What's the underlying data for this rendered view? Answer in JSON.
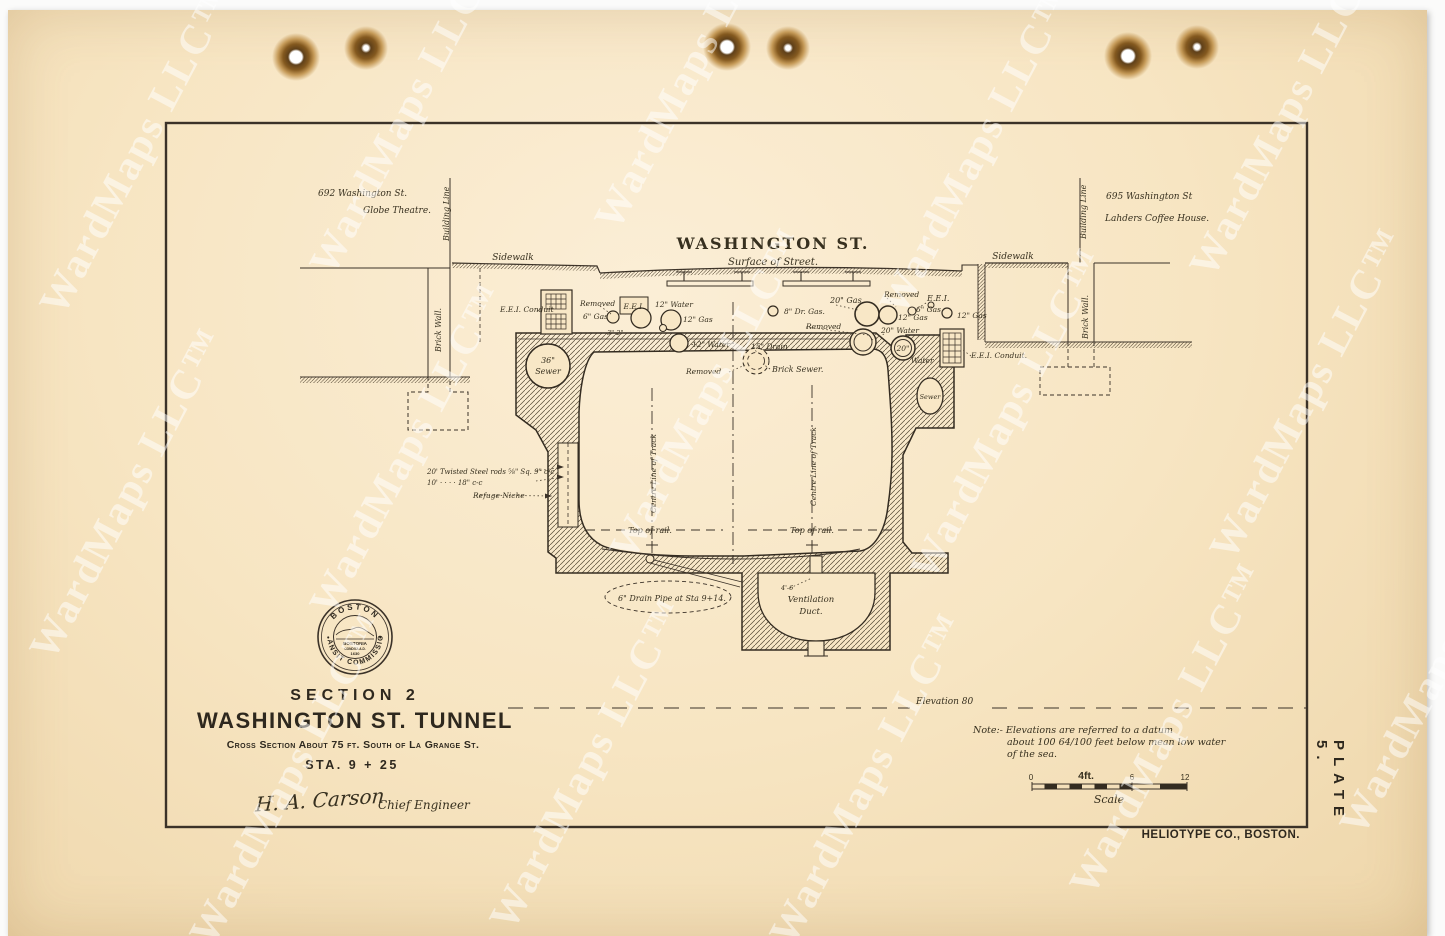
{
  "watermark": {
    "text": "WardMaps LLC™"
  },
  "page": {
    "plate": "PLATE 5.",
    "printer": "HELIOTYPE CO., BOSTON."
  },
  "title_block": {
    "section": "SECTION 2",
    "title": "WASHINGTON ST. TUNNEL",
    "subtitle": "Cross Section About 75 ft. South of La Grange St.",
    "station": "STA. 9 + 25",
    "signature": "H. A. Carson",
    "signature_role": "Chief Engineer"
  },
  "seal": {
    "arc_top": "BOSTON",
    "arc_bottom": "TRANSIT COMMISSION",
    "dot_left": "•",
    "dot_right": "•",
    "inner_line1": "BOSTONIA",
    "inner_line2": "CONDITA A.D.",
    "inner_line3": "1630"
  },
  "note": {
    "line1": "Note:- Elevations are referred to a datum",
    "line2": "about 100 64/100 feet below mean low water",
    "line3": "of the sea."
  },
  "drawing_labels": [
    {
      "t": "692 Washington St.",
      "x": 318,
      "y": 196,
      "s": 9
    },
    {
      "t": "Globe Theatre.",
      "x": 363,
      "y": 213,
      "s": 9
    },
    {
      "t": "Building Line",
      "x": 449,
      "y": 241,
      "r": -90
    },
    {
      "t": "Sidewalk",
      "x": 513,
      "y": 260,
      "a": "middle",
      "s": 9
    },
    {
      "t": "Brick Wall.",
      "x": 441,
      "y": 352,
      "r": -90
    },
    {
      "t": "E.E.I. Conduit",
      "x": 500,
      "y": 312,
      "s": 7.5
    },
    {
      "t": "Removed",
      "x": 580,
      "y": 306,
      "s": 7.5
    },
    {
      "t": "6\" Gas",
      "x": 583,
      "y": 319,
      "s": 7.5
    },
    {
      "t": "E.E.I.",
      "x": 634,
      "y": 309,
      "a": "middle",
      "s": 7.5
    },
    {
      "t": "12\" Water",
      "x": 655,
      "y": 307,
      "s": 7.5
    },
    {
      "t": "12\" Gas",
      "x": 683,
      "y": 322,
      "s": 7.5
    },
    {
      "t": "3\"  2\"",
      "x": 607,
      "y": 335,
      "s": 6.5
    },
    {
      "t": "12\" Water",
      "x": 692,
      "y": 347,
      "s": 7.5
    },
    {
      "t": "15\" Drain",
      "x": 751,
      "y": 349,
      "s": 7.5
    },
    {
      "t": "Brick Sewer.",
      "x": 772,
      "y": 372,
      "s": 8
    },
    {
      "t": "Removed",
      "x": 686,
      "y": 374,
      "s": 7.5
    },
    {
      "t": "Removed",
      "x": 806,
      "y": 329,
      "s": 7.5
    },
    {
      "t": "8\" Dr. Gas.",
      "x": 784,
      "y": 314,
      "s": 7.5
    },
    {
      "t": "20\" Gas",
      "x": 830,
      "y": 303,
      "s": 8
    },
    {
      "t": "Removed",
      "x": 884,
      "y": 297,
      "s": 7.5
    },
    {
      "t": "12\" Gas",
      "x": 898,
      "y": 320,
      "s": 7.5
    },
    {
      "t": "E.E.I.",
      "x": 927,
      "y": 301,
      "s": 8
    },
    {
      "t": "6\" Gas",
      "x": 916,
      "y": 312,
      "s": 7.5
    },
    {
      "t": "12\" Gas",
      "x": 957,
      "y": 318,
      "s": 7.5
    },
    {
      "t": "20\" Water",
      "x": 881,
      "y": 333,
      "s": 7.5
    },
    {
      "t": "20\"",
      "x": 903,
      "y": 351,
      "a": "middle",
      "s": 7.5
    },
    {
      "t": "Water",
      "x": 911,
      "y": 363,
      "s": 7.5
    },
    {
      "t": "E.E.I. Conduit.",
      "x": 971,
      "y": 358,
      "s": 7.5
    },
    {
      "t": "Sewer",
      "x": 930,
      "y": 399,
      "a": "middle",
      "s": 6.5
    },
    {
      "t": "36\"",
      "x": 548,
      "y": 363,
      "a": "middle",
      "s": 8
    },
    {
      "t": "Sewer",
      "x": 548,
      "y": 374,
      "a": "middle",
      "s": 8
    },
    {
      "t": "WASHINGTON ST.",
      "x": 773,
      "y": 249,
      "a": "middle",
      "s": 16,
      "c": "big"
    },
    {
      "t": "Surface of Street.",
      "x": 773,
      "y": 265,
      "a": "middle",
      "s": 10
    },
    {
      "t": "Sidewalk",
      "x": 1013,
      "y": 259,
      "a": "middle",
      "s": 9
    },
    {
      "t": "Building Line",
      "x": 1086,
      "y": 239,
      "r": -90
    },
    {
      "t": "695 Washington St",
      "x": 1106,
      "y": 199,
      "s": 9
    },
    {
      "t": "Lahders Coffee House.",
      "x": 1105,
      "y": 221,
      "s": 9
    },
    {
      "t": "Brick Wall.",
      "x": 1088,
      "y": 339,
      "r": -90
    },
    {
      "t": "Centre Line of Track",
      "x": 656,
      "y": 513,
      "r": -90,
      "s": 7.5
    },
    {
      "t": "Centre Line of Track",
      "x": 816,
      "y": 506,
      "r": -90,
      "s": 7.5
    },
    {
      "t": "Top of  rail.",
      "x": 650,
      "y": 533,
      "a": "middle"
    },
    {
      "t": "Top of  rail.",
      "x": 812,
      "y": 533,
      "a": "middle"
    },
    {
      "t": "20' Twisted Steel rods ⅝\" Sq. 9\" c-c",
      "x": 427,
      "y": 474,
      "s": 7
    },
    {
      "t": "10'    ·     ·     ·     ·    18\" c-c",
      "x": 427,
      "y": 485,
      "s": 7
    },
    {
      "t": "Refuge Niche",
      "x": 473,
      "y": 498,
      "s": 7.5
    },
    {
      "t": "6\" Drain Pipe at Sta 9+14.",
      "x": 618,
      "y": 601,
      "s": 8
    },
    {
      "t": "Ventilation",
      "x": 811,
      "y": 602,
      "a": "middle",
      "s": 8.5
    },
    {
      "t": "Duct.",
      "x": 811,
      "y": 614,
      "a": "middle",
      "s": 8.5
    },
    {
      "t": "4'-6",
      "x": 781,
      "y": 590,
      "s": 6.5
    },
    {
      "t": "Elevation 80",
      "x": 916,
      "y": 704,
      "s": 9
    },
    {
      "t": "0",
      "x": 1031,
      "y": 780,
      "a": "middle",
      "c": "tick"
    },
    {
      "t": "4ft.",
      "x": 1086,
      "y": 779,
      "a": "middle",
      "s": 10.5,
      "c": "tickb"
    },
    {
      "t": "6",
      "x": 1132,
      "y": 780,
      "a": "middle",
      "c": "tick"
    },
    {
      "t": "12",
      "x": 1185,
      "y": 780,
      "a": "middle",
      "c": "tick"
    },
    {
      "t": "Scale",
      "x": 1109,
      "y": 803,
      "a": "middle",
      "s": 11
    }
  ]
}
